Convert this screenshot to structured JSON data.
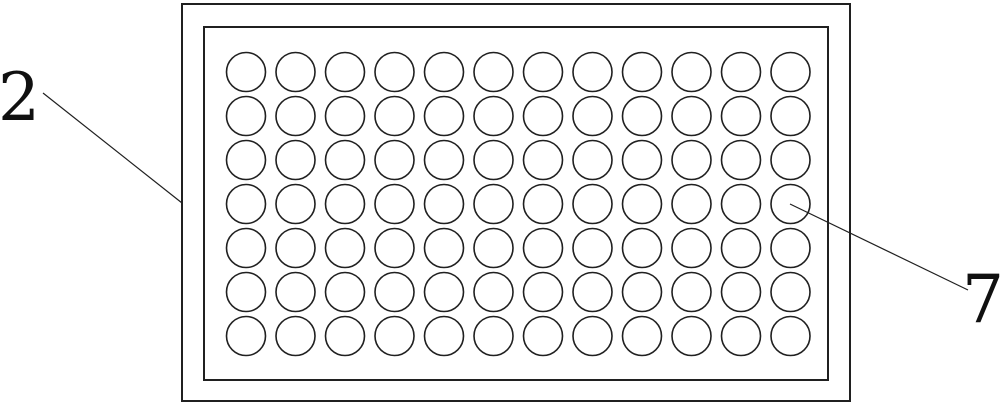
{
  "figure": {
    "description": "perforated-plate-top-view",
    "background_color": "#ffffff",
    "line_color": "#202020",
    "outer_plate": {
      "x": 182,
      "y": 4,
      "width": 668,
      "height": 397,
      "stroke_width": 2
    },
    "inner_plate": {
      "x": 204,
      "y": 27,
      "width": 624,
      "height": 353,
      "stroke_width": 2
    },
    "hole_grid": {
      "rows": 7,
      "cols": 12,
      "start_x": 246,
      "start_y": 72,
      "spacing_x": 49.5,
      "spacing_y": 44,
      "radius": 19.5,
      "stroke_width": 1.6
    },
    "annotations": [
      {
        "label": "2",
        "font_size": 66,
        "text_x": 19,
        "text_y": 120,
        "line_x1": 43,
        "line_y1": 93,
        "line_x2": 182,
        "line_y2": 203
      },
      {
        "label": "7",
        "font_size": 66,
        "text_x": 983,
        "text_y": 322,
        "line_x1": 790,
        "line_y1": 204,
        "line_x2": 968,
        "line_y2": 290
      }
    ]
  }
}
